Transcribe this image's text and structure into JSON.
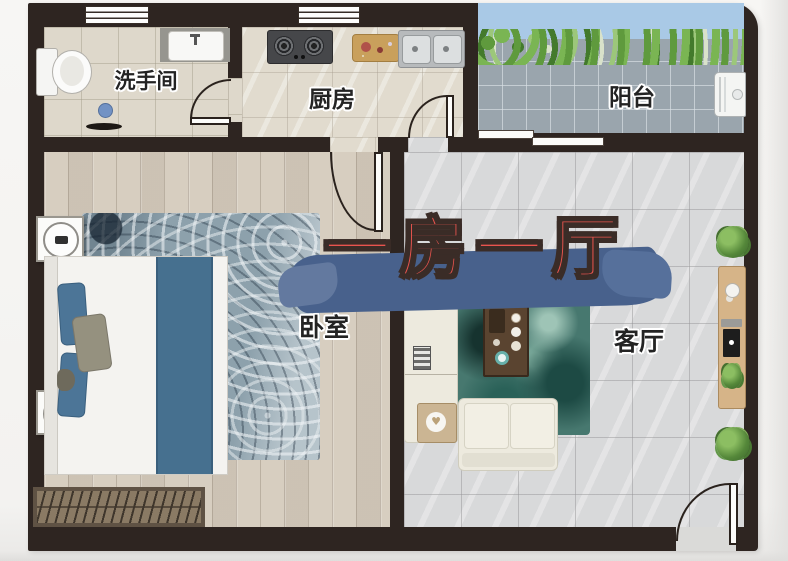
{
  "title": {
    "text": "一房一厅",
    "color": "#e8544e",
    "brush_color": "#48618c",
    "outline_color": "#3a2c27"
  },
  "rooms": {
    "bathroom": {
      "label": "洗手间",
      "items": [
        "toilet",
        "washbasin",
        "floor-drain",
        "window",
        "swing-door"
      ]
    },
    "kitchen": {
      "label": "厨房",
      "items": [
        "gas-stove",
        "cutting-board",
        "double-sink",
        "window",
        "swing-door"
      ]
    },
    "balcony": {
      "label": "阳台",
      "items": [
        "plant-hedge",
        "washing-machine",
        "sliding-door"
      ]
    },
    "bedroom": {
      "label": "卧室",
      "items": [
        "double-bed",
        "nightstand",
        "nightstand",
        "area-rug",
        "doormat",
        "swing-door"
      ]
    },
    "living_room": {
      "label": "客厅",
      "items": [
        "l-sofa",
        "coffee-table",
        "side-table",
        "area-rug",
        "tv-console",
        "potted-plant",
        "potted-plant",
        "entrance-door"
      ]
    }
  },
  "colors": {
    "wall": "#2e2521",
    "balcony_sky": "#a9c9e6",
    "bed_accent_blue": "#46708f",
    "teal_rug": "#47786f",
    "wood_floor": "#d7cec0",
    "tile_gray": "#d8d9da"
  },
  "glyphs": {
    "heart": "♥"
  }
}
